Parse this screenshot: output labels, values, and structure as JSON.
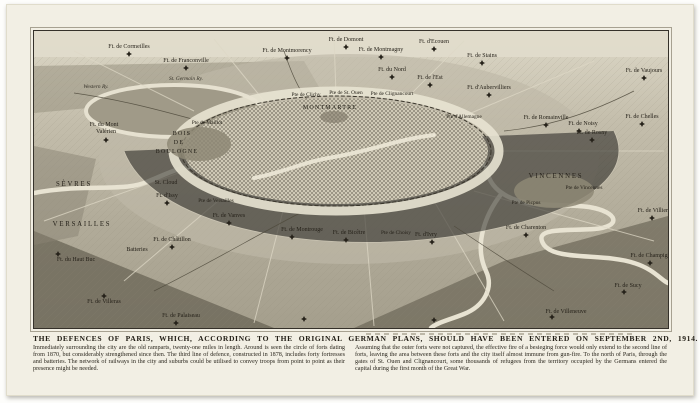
{
  "page": {
    "caption_title": "THE DEFENCES OF PARIS, WHICH, ACCORDING TO THE ORIGINAL GERMAN PLANS, SHOULD HAVE BEEN ENTERED ON SEPTEMBER 2ND, 1914.",
    "caption_left": "Immediately surrounding the city are the old ramparts, twenty-one miles in length. Around is seen the circle of forts dating from 1870, but considerably strengthened since then. The third line of defence, constructed in 1878, includes forty fortresses and batteries. The network of railways in the city and suburbs could be utilised to convey troops from point to point as their presence might be needed.",
    "caption_right": "Assuming that the outer forts were not captured, the effective fire of a besieging force would only extend to the second line of forts, leaving the area between these forts and the city itself almost immune from gun-fire. To the north of Paris, through the gates of St. Ouen and Clignancourt, some thousands of refugees from the territory occupied by the Germans entered the capital during the first month of the Great War."
  },
  "map": {
    "colors": {
      "paper": "#f2efe4",
      "ink": "#26221a",
      "river_light": "#e8e3d2",
      "terrain_mid": "#b3ad9b",
      "terrain_dark": "#6d6859"
    },
    "labels": [
      {
        "text": "Ft. de Cormeilles",
        "x": 95,
        "y": 17,
        "cls": "f"
      },
      {
        "text": "Ft. de Franconville",
        "x": 152,
        "y": 31,
        "cls": "f"
      },
      {
        "text": "Ft. de Montmorency",
        "x": 253,
        "y": 21,
        "cls": "f"
      },
      {
        "text": "Ft. de Domont",
        "x": 312,
        "y": 10,
        "cls": "f"
      },
      {
        "text": "Ft. de Montmagny",
        "x": 347,
        "y": 20,
        "cls": "f"
      },
      {
        "text": "Ft. d'Ecouen",
        "x": 400,
        "y": 12,
        "cls": "f"
      },
      {
        "text": "Ft. de Stains",
        "x": 448,
        "y": 26,
        "cls": "f"
      },
      {
        "text": "Ft. de Vaujours",
        "x": 610,
        "y": 41,
        "cls": "f"
      },
      {
        "text": "Ft. du Nord",
        "x": 358,
        "y": 40,
        "cls": "f"
      },
      {
        "text": "Ft. de l'Est",
        "x": 396,
        "y": 48,
        "cls": "f"
      },
      {
        "text": "Ft. d'Aubervilliers",
        "x": 455,
        "y": 58,
        "cls": "f"
      },
      {
        "text": "Ft. de Romainville",
        "x": 512,
        "y": 88,
        "cls": "f"
      },
      {
        "text": "Ft. de Noisy",
        "x": 549,
        "y": 94,
        "cls": "f"
      },
      {
        "text": "Ft. de Rosny",
        "x": 558,
        "y": 103,
        "cls": "f"
      },
      {
        "text": "Ft. de Chelles",
        "x": 608,
        "y": 87,
        "cls": "f"
      },
      {
        "text": "Ft. de Villiers",
        "x": 620,
        "y": 181,
        "cls": "f"
      },
      {
        "text": "Ft. de Champigny",
        "x": 618,
        "y": 226,
        "cls": "f"
      },
      {
        "text": "Ft. de Sucy",
        "x": 594,
        "y": 256,
        "cls": "f"
      },
      {
        "text": "Ft. de Villeneuve",
        "x": 532,
        "y": 282,
        "cls": "f"
      },
      {
        "text": "Ft. de Palaiseau",
        "x": 147,
        "y": 286,
        "cls": "f"
      },
      {
        "text": "Ft. de Villeras",
        "x": 70,
        "y": 272,
        "cls": "f"
      },
      {
        "text": "Ft. du Haut Buc",
        "x": 42,
        "y": 230,
        "cls": "f"
      },
      {
        "text": "Batteries",
        "x": 103,
        "y": 220,
        "cls": "f"
      },
      {
        "text": "Ft. de Châtillon",
        "x": 138,
        "y": 210,
        "cls": "f"
      },
      {
        "text": "Ft. de Montrouge",
        "x": 268,
        "y": 200,
        "cls": "f"
      },
      {
        "text": "Ft. de Bicêtre",
        "x": 315,
        "y": 203,
        "cls": "f"
      },
      {
        "text": "Ft. d'Ivry",
        "x": 392,
        "y": 205,
        "cls": "f"
      },
      {
        "text": "Ft. de Charenton",
        "x": 492,
        "y": 198,
        "cls": "f"
      },
      {
        "text": "Ft. d'Issy",
        "x": 133,
        "y": 166,
        "cls": "f"
      },
      {
        "text": "Ft. de Vanves",
        "x": 195,
        "y": 186,
        "cls": "f"
      },
      {
        "text": "Ft. du Mont",
        "x": 70,
        "y": 95,
        "cls": "f"
      },
      {
        "text": "Valérien",
        "x": 72,
        "y": 102,
        "cls": "f"
      },
      {
        "text": "St. Cloud",
        "x": 132,
        "y": 153,
        "cls": "f"
      },
      {
        "text": "Pte de Clichy",
        "x": 272,
        "y": 65,
        "cls": "g"
      },
      {
        "text": "Pte de St. Ouen",
        "x": 312,
        "y": 63,
        "cls": "g"
      },
      {
        "text": "Pte de Clignancourt",
        "x": 358,
        "y": 64,
        "cls": "g"
      },
      {
        "text": "Pte d'Allemagne",
        "x": 430,
        "y": 87,
        "cls": "g"
      },
      {
        "text": "Pte de Maillot",
        "x": 173,
        "y": 93,
        "cls": "g"
      },
      {
        "text": "Pte de Versailles",
        "x": 182,
        "y": 171,
        "cls": "g"
      },
      {
        "text": "Pte de Choisy",
        "x": 362,
        "y": 203,
        "cls": "g"
      },
      {
        "text": "Pte de Picpus",
        "x": 492,
        "y": 173,
        "cls": "g"
      },
      {
        "text": "Pte de Vincennes",
        "x": 550,
        "y": 158,
        "cls": "g"
      },
      {
        "text": "MONTMARTRE",
        "x": 296,
        "y": 78,
        "cls": "p2"
      },
      {
        "text": "VINCENNES",
        "x": 522,
        "y": 147,
        "cls": "p"
      },
      {
        "text": "SÈVRES",
        "x": 40,
        "y": 155,
        "cls": "p"
      },
      {
        "text": "VERSAILLES",
        "x": 48,
        "y": 195,
        "cls": "p"
      },
      {
        "text": "BOIS",
        "x": 148,
        "y": 104,
        "cls": "p2"
      },
      {
        "text": "DE",
        "x": 145,
        "y": 113,
        "cls": "p2"
      },
      {
        "text": "BOULOGNE",
        "x": 143,
        "y": 122,
        "cls": "p2"
      },
      {
        "text": "Western Ry.",
        "x": 62,
        "y": 57,
        "cls": "r"
      },
      {
        "text": "St. Germain Ry.",
        "x": 152,
        "y": 49,
        "cls": "r"
      }
    ],
    "forts": [
      {
        "x": 95,
        "y": 23
      },
      {
        "x": 152,
        "y": 37
      },
      {
        "x": 253,
        "y": 27
      },
      {
        "x": 312,
        "y": 16
      },
      {
        "x": 347,
        "y": 26
      },
      {
        "x": 400,
        "y": 18
      },
      {
        "x": 448,
        "y": 32
      },
      {
        "x": 610,
        "y": 47
      },
      {
        "x": 358,
        "y": 46
      },
      {
        "x": 396,
        "y": 54
      },
      {
        "x": 455,
        "y": 64
      },
      {
        "x": 512,
        "y": 94
      },
      {
        "x": 545,
        "y": 100
      },
      {
        "x": 558,
        "y": 109
      },
      {
        "x": 608,
        "y": 93
      },
      {
        "x": 618,
        "y": 187
      },
      {
        "x": 616,
        "y": 232
      },
      {
        "x": 590,
        "y": 261
      },
      {
        "x": 518,
        "y": 286
      },
      {
        "x": 142,
        "y": 292
      },
      {
        "x": 70,
        "y": 265
      },
      {
        "x": 24,
        "y": 223
      },
      {
        "x": 138,
        "y": 216
      },
      {
        "x": 258,
        "y": 206
      },
      {
        "x": 312,
        "y": 209
      },
      {
        "x": 398,
        "y": 211
      },
      {
        "x": 492,
        "y": 204
      },
      {
        "x": 133,
        "y": 172
      },
      {
        "x": 195,
        "y": 192
      },
      {
        "x": 72,
        "y": 109
      },
      {
        "x": 270,
        "y": 288
      },
      {
        "x": 400,
        "y": 289
      }
    ]
  }
}
